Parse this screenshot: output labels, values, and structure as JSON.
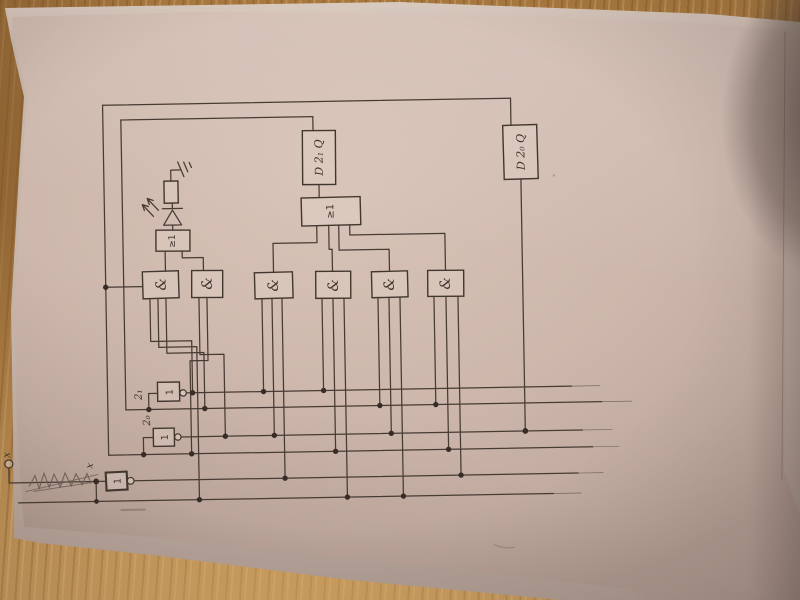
{
  "schematic": {
    "flip_flops": [
      {
        "id": "ff-2-1",
        "label": "D 2₁ Q"
      },
      {
        "id": "ff-2-0",
        "label": "D 2₀ Q"
      }
    ],
    "or_gates": [
      {
        "label": "≥1"
      },
      {
        "label": "≥1"
      }
    ],
    "and_gate_label": "&",
    "and_gate_count": 6,
    "inverter_label": "1",
    "signal_labels": {
      "bit1": "2₁",
      "bit0": "2₀",
      "input_x": "x",
      "junction_x": "x"
    },
    "colors": {
      "ink": "#473b33",
      "paper": "#cdb7ac",
      "wood": "#b5854a"
    }
  }
}
